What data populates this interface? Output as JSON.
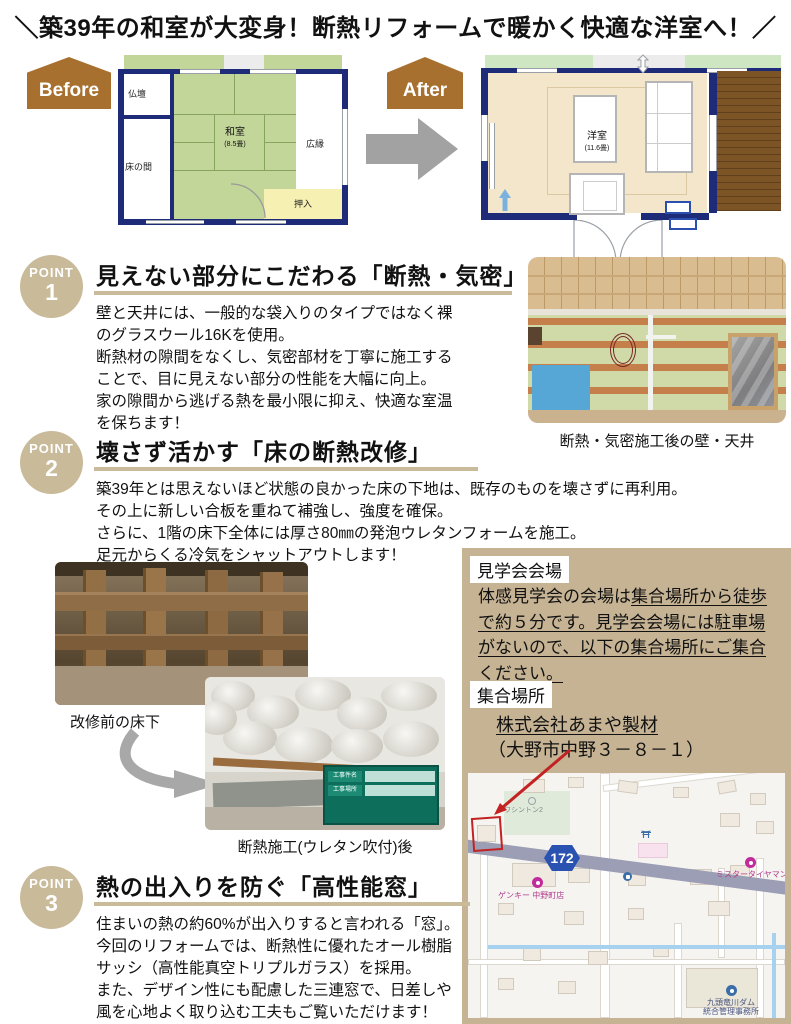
{
  "title": "＼築39年の和室が大変身！断熱リフォームで暖かく快適な洋室へ！／",
  "before_after": {
    "before_label": "Before",
    "after_label": "After",
    "plan_before": {
      "butsudan": "仏壇",
      "tokonoma": "床の間",
      "room": "和室",
      "room_size": "(8.5畳)",
      "hiroen": "広縁",
      "oshiire": "押入"
    },
    "plan_after": {
      "room": "洋室",
      "room_size": "(11.6畳)"
    }
  },
  "point1": {
    "badge": "POINT",
    "number": "1",
    "heading": "見えない部分にこだわる「断熱・気密」",
    "body": "壁と天井には、一般的な袋入りのタイプではなく裸\nのグラスウール16Kを使用。\n断熱材の隙間をなくし、気密部材を丁寧に施工する\nことで、目に見えない部分の性能を大幅に向上。\n家の隙間から逃げる熱を最小限に抑え、快適な室温\nを保ちます！",
    "photo_caption": "断熱・気密施工後の壁・天井"
  },
  "point2": {
    "badge": "POINT",
    "number": "2",
    "heading": "壊さず活かす「床の断熱改修」",
    "body": "築39年とは思えないほど状態の良かった床の下地は、既存のものを壊さずに再利用。\nその上に新しい合板を重ねて補強し、強度を確保。\nさらに、1階の床下全体には厚さ80㎜の発泡ウレタンフォームを施工。\n足元からくる冷気をシャットアウトします！",
    "photo_before_caption": "改修前の床下",
    "photo_after_caption": "断熱施工(ウレタン吹付)後",
    "board_row1": "工事件名",
    "board_row2": "工事場所"
  },
  "point3": {
    "badge": "POINT",
    "number": "3",
    "heading": "熱の出入りを防ぐ「高性能窓」",
    "body": "住まいの熱の約60%が出入りすると言われる「窓」。\n今回のリフォームでは、断熱性に優れたオール樹脂\nサッシ（高性能真空トリプルガラス）を採用。\nまた、デザイン性にも配慮した三連窓で、日差しや\n風を心地よく取り込む工夫もご覧いただけます！"
  },
  "venue": {
    "venue_label": "見学会会場",
    "text_plain": "体感見学会の会場は",
    "text_underlined": "集合場所から徒歩で約５分です。見学会会場には駐車場がないので、以下の集合場所にご集合ください。",
    "meeting_label": "集合場所",
    "company": "株式会社あまや製材",
    "address": "（大野市中野３－８－１）"
  },
  "map": {
    "route_number": "172",
    "label_apartment": "ワシントン2",
    "label_genky": "ゲンキー 中野町店",
    "label_tireman": "ミスタータイヤマン",
    "label_dam_line1": "九頭竜川ダム",
    "label_dam_line2": "統合管理事務所"
  },
  "colors": {
    "accent_tan": "#c9ba99",
    "badge_brown": "#a8702e",
    "wall_navy": "#1e2b78",
    "tatami_green": "#c3d69a",
    "route_blue": "#2a52b0",
    "marker_red": "#c32222"
  }
}
